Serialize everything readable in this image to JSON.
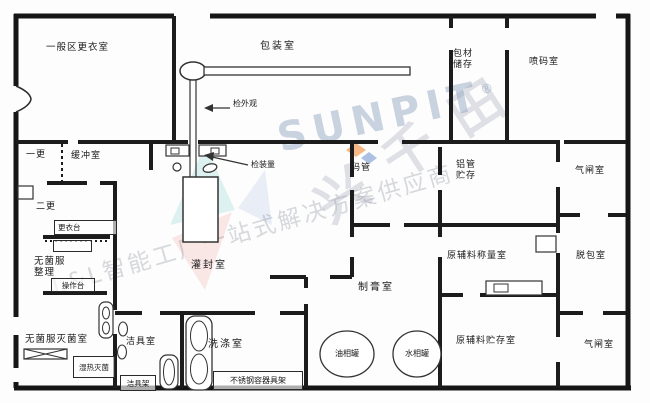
{
  "rooms": {
    "general_changing": "一般区更衣室",
    "packaging": "包装室",
    "packmat_storage": "包材储存",
    "inkjet": "喷码室",
    "change1": "一更",
    "buffer": "缓冲室",
    "change2": "二更",
    "changing_table": "更衣台",
    "sterile_garment_sorting": "无菌服整理",
    "operation_table": "操作台",
    "sterile_garment_sterilizing": "无菌服灭菌室",
    "moist_heat_sterilizer": "湿热灭菌",
    "cleaning_tools": "洁具室",
    "cleaning_rack": "洁具架",
    "washing": "洗涤室",
    "steel_container_rack": "不锈钢容器具架",
    "filling_sealing": "灌封室",
    "tube_coding": "码管",
    "alu_tube_storage": "铝管贮存",
    "airlock_top": "气闸室",
    "depacking": "脱包室",
    "raw_weighing": "原辅料称量室",
    "cream_making": "制膏室",
    "oil_tank": "油相罐",
    "water_tank": "水相罐",
    "raw_storage": "原辅料贮存室",
    "airlock_bottom": "气闸室"
  },
  "annotations": {
    "check_appearance": "检外观",
    "check_fill": "检装量"
  },
  "watermark": {
    "logo": "SUNPIT",
    "reg": "®",
    "brand": "兴千田",
    "tagline": "L&L智能工厂一站式解决方案供应商"
  },
  "colors": {
    "wall": "#1c1c1c",
    "equipment": "#333333",
    "watermark_blue": "#9fb0c8",
    "watermark_gray": "#9ca1ab",
    "accent_orange": "#f08223",
    "accent_teal": "#35b6ae",
    "accent_red": "#e25548",
    "accent_blue": "#4a78c2"
  }
}
